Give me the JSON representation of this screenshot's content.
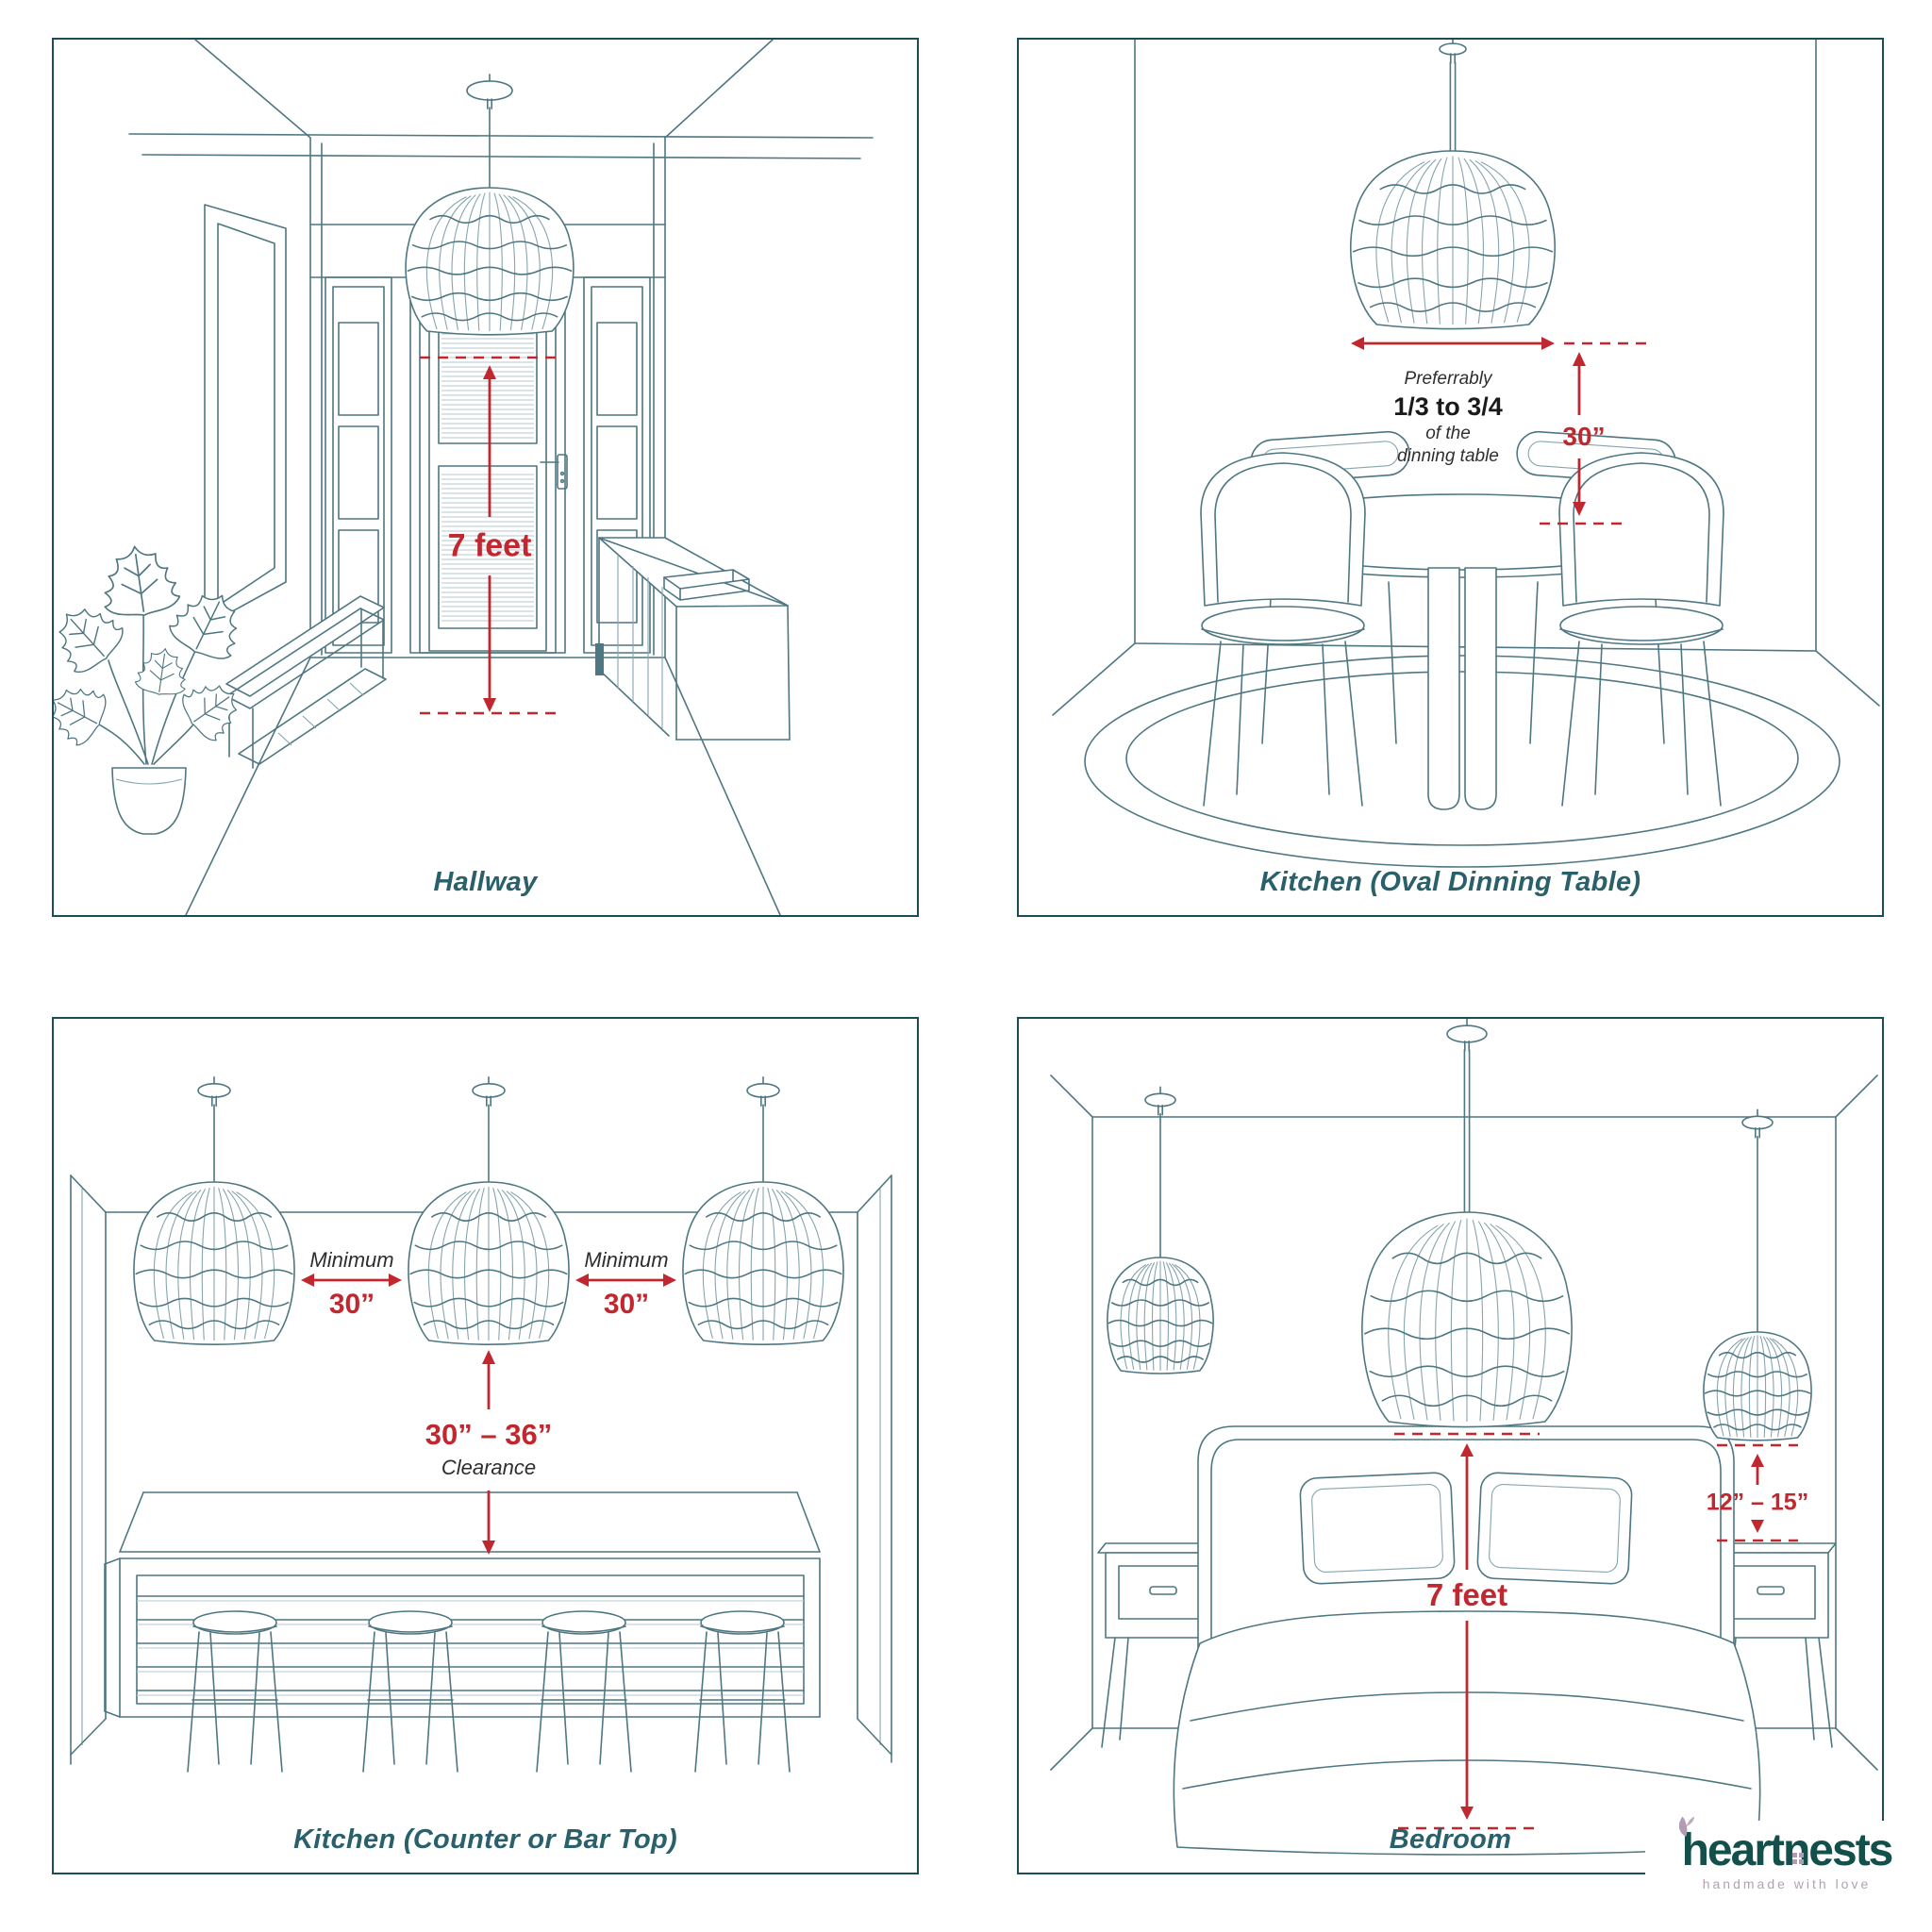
{
  "colors": {
    "line_art": "#4e7781",
    "panel_border": "#1b4d57",
    "caption_teal": "#29606a",
    "dimension_red": "#c1272f",
    "note_text": "#2e2e2e",
    "logo_teal": "#14504b",
    "logo_mauve": "#b39cb2"
  },
  "icons": {
    "pendant": "pendant-lamp-icon",
    "leaf": "leaf-icon",
    "window": "house-window-icon"
  },
  "panels": {
    "hallway": {
      "caption": "Hallway",
      "height_label": "7 feet"
    },
    "kitchen_oval": {
      "caption": "Kitchen (Oval Dinning Table)",
      "note_line1": "Preferrably",
      "note_line2": "1/3 to 3/4",
      "note_line3": "of the",
      "note_line4": "dinning table",
      "drop_label": "30”"
    },
    "kitchen_counter": {
      "caption": "Kitchen (Counter or Bar Top)",
      "min_label": "Minimum",
      "min_value": "30”",
      "clearance_value": "30” – 36”",
      "clearance_label": "Clearance"
    },
    "bedroom": {
      "caption": "Bedroom",
      "height_label": "7 feet",
      "side_label": "12” – 15”"
    }
  },
  "logo": {
    "wordmark": "heartnests",
    "tagline": "handmade with love"
  }
}
